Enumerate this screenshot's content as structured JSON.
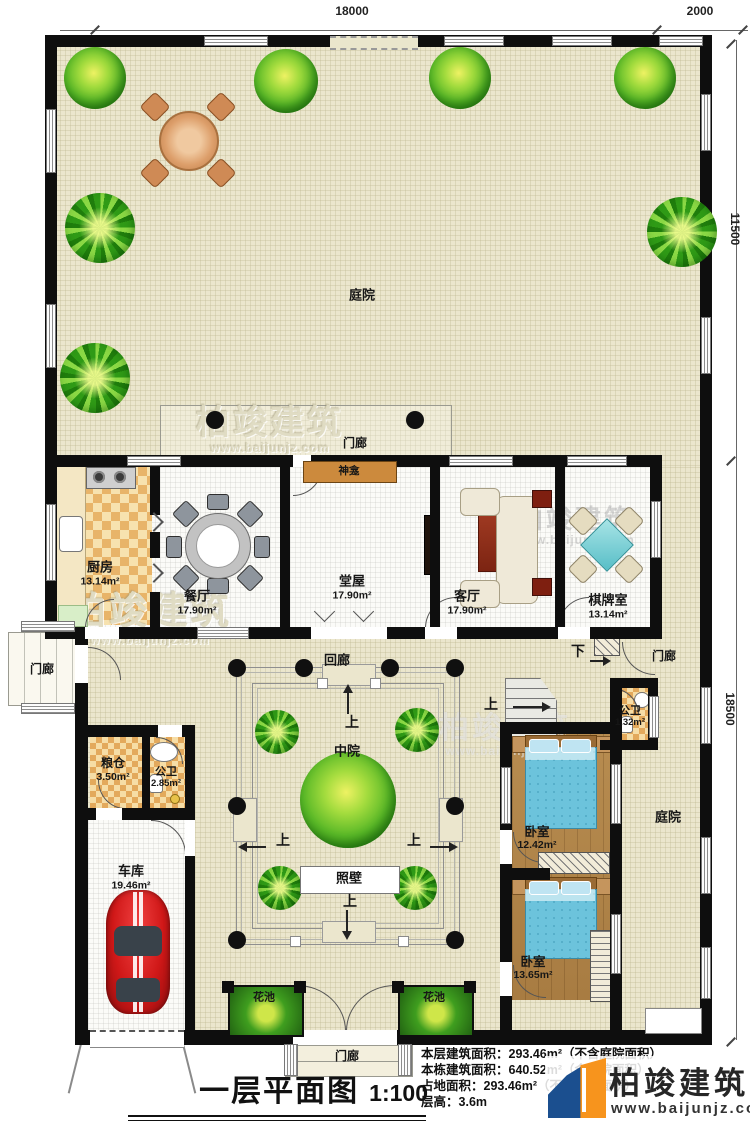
{
  "title_block": {
    "title": "一层平面图",
    "scale": "1:100",
    "stats": [
      {
        "label": "本层建筑面积：",
        "value": "293.46m²（不含庭院面积）"
      },
      {
        "label": "本栋建筑面积：",
        "value": "640.52m²（含庭院面积）"
      },
      {
        "label": "占地面积：",
        "value": "293.46m²（不含庭院面积）"
      },
      {
        "label": "层高：",
        "value": "3.6m"
      }
    ]
  },
  "logo": {
    "name": "柏竣建筑",
    "website": "www.baijunjz.com"
  },
  "watermark": {
    "name": "柏竣建筑",
    "website": "www.baijunjz.com"
  },
  "dimensions": {
    "top_main": "18000",
    "top_right": "2000",
    "right_upper": "11500",
    "right_lower": "18500"
  },
  "rooms": {
    "courtyard_top": {
      "label": "庭院"
    },
    "courtyard_right": {
      "label": "庭院"
    },
    "kitchen": {
      "label": "厨房",
      "area": "13.14m²"
    },
    "dining": {
      "label": "餐厅",
      "area": "17.90m²"
    },
    "hall": {
      "label": "堂屋",
      "area": "17.90m²"
    },
    "living": {
      "label": "客厅",
      "area": "17.90m²"
    },
    "chess": {
      "label": "棋牌室",
      "area": "13.14m²"
    },
    "granary": {
      "label": "粮仓",
      "area": "3.50m²"
    },
    "bath_main": {
      "label": "公卫",
      "area": "2.85m²"
    },
    "bath_small": {
      "label": "公卫",
      "area": "1.32m²"
    },
    "garage": {
      "label": "车库",
      "area": "19.46m²"
    },
    "bedroom1": {
      "label": "卧室",
      "area": "12.42m²"
    },
    "bedroom2": {
      "label": "卧室",
      "area": "13.65m²"
    }
  },
  "features": {
    "porch": "门廊",
    "corridor": "回廊",
    "mid_court": "中院",
    "screen_wall": "照壁",
    "shrine": "神龛",
    "flower_bed": "花池",
    "up": "上",
    "down": "下"
  }
}
